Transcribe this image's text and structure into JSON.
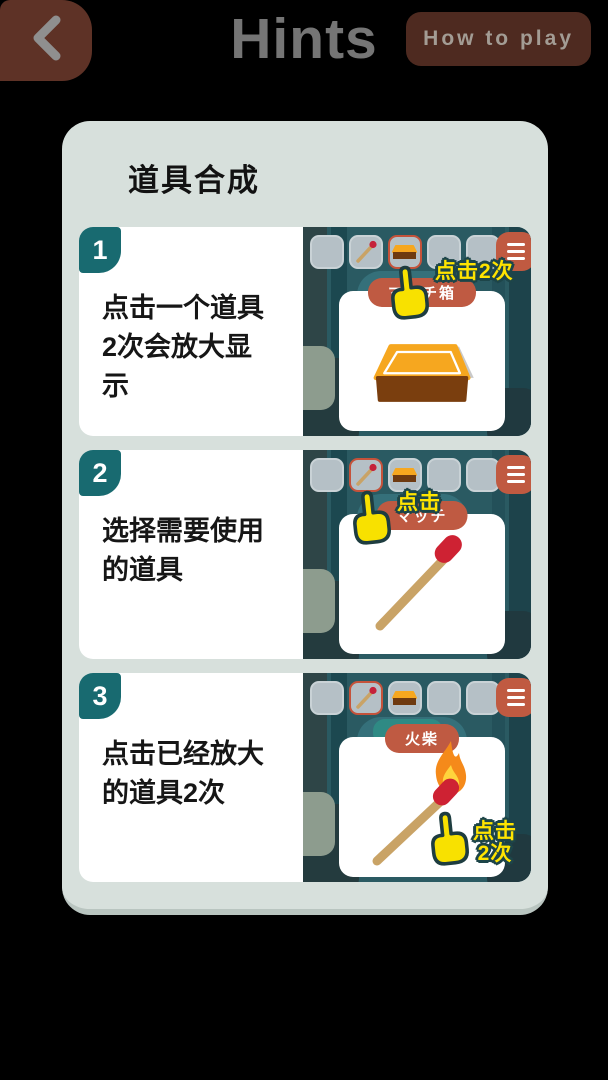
{
  "header": {
    "title": "Hints",
    "how_to_play": "How to play"
  },
  "panel": {
    "title": "道具合成",
    "steps": [
      {
        "num": "1",
        "text": "点击一个道具\n2次会放大显\n示",
        "callout": "点击2次",
        "item_label": "マッチ箱"
      },
      {
        "num": "2",
        "text": "选择需要使用\n的道具",
        "callout": "点击",
        "item_label": "マッチ"
      },
      {
        "num": "3",
        "text": "点击已经放大\n的道具2次",
        "callout": "点击\n2次",
        "item_label": "火柴"
      }
    ]
  },
  "colors": {
    "page_bg": "#000000",
    "panel_bg": "#d7e0dc",
    "badge_teal": "#186a70",
    "accent_rust": "#bf5a42",
    "callout_yellow": "#ffe400",
    "slot_gray": "#b5c0c6",
    "forest_teal": "#2a5a62",
    "match_stick": "#c9a366",
    "match_head": "#ce2233",
    "matchbox_orange": "#f6a71f",
    "matchbox_brown": "#7a3e0e"
  }
}
